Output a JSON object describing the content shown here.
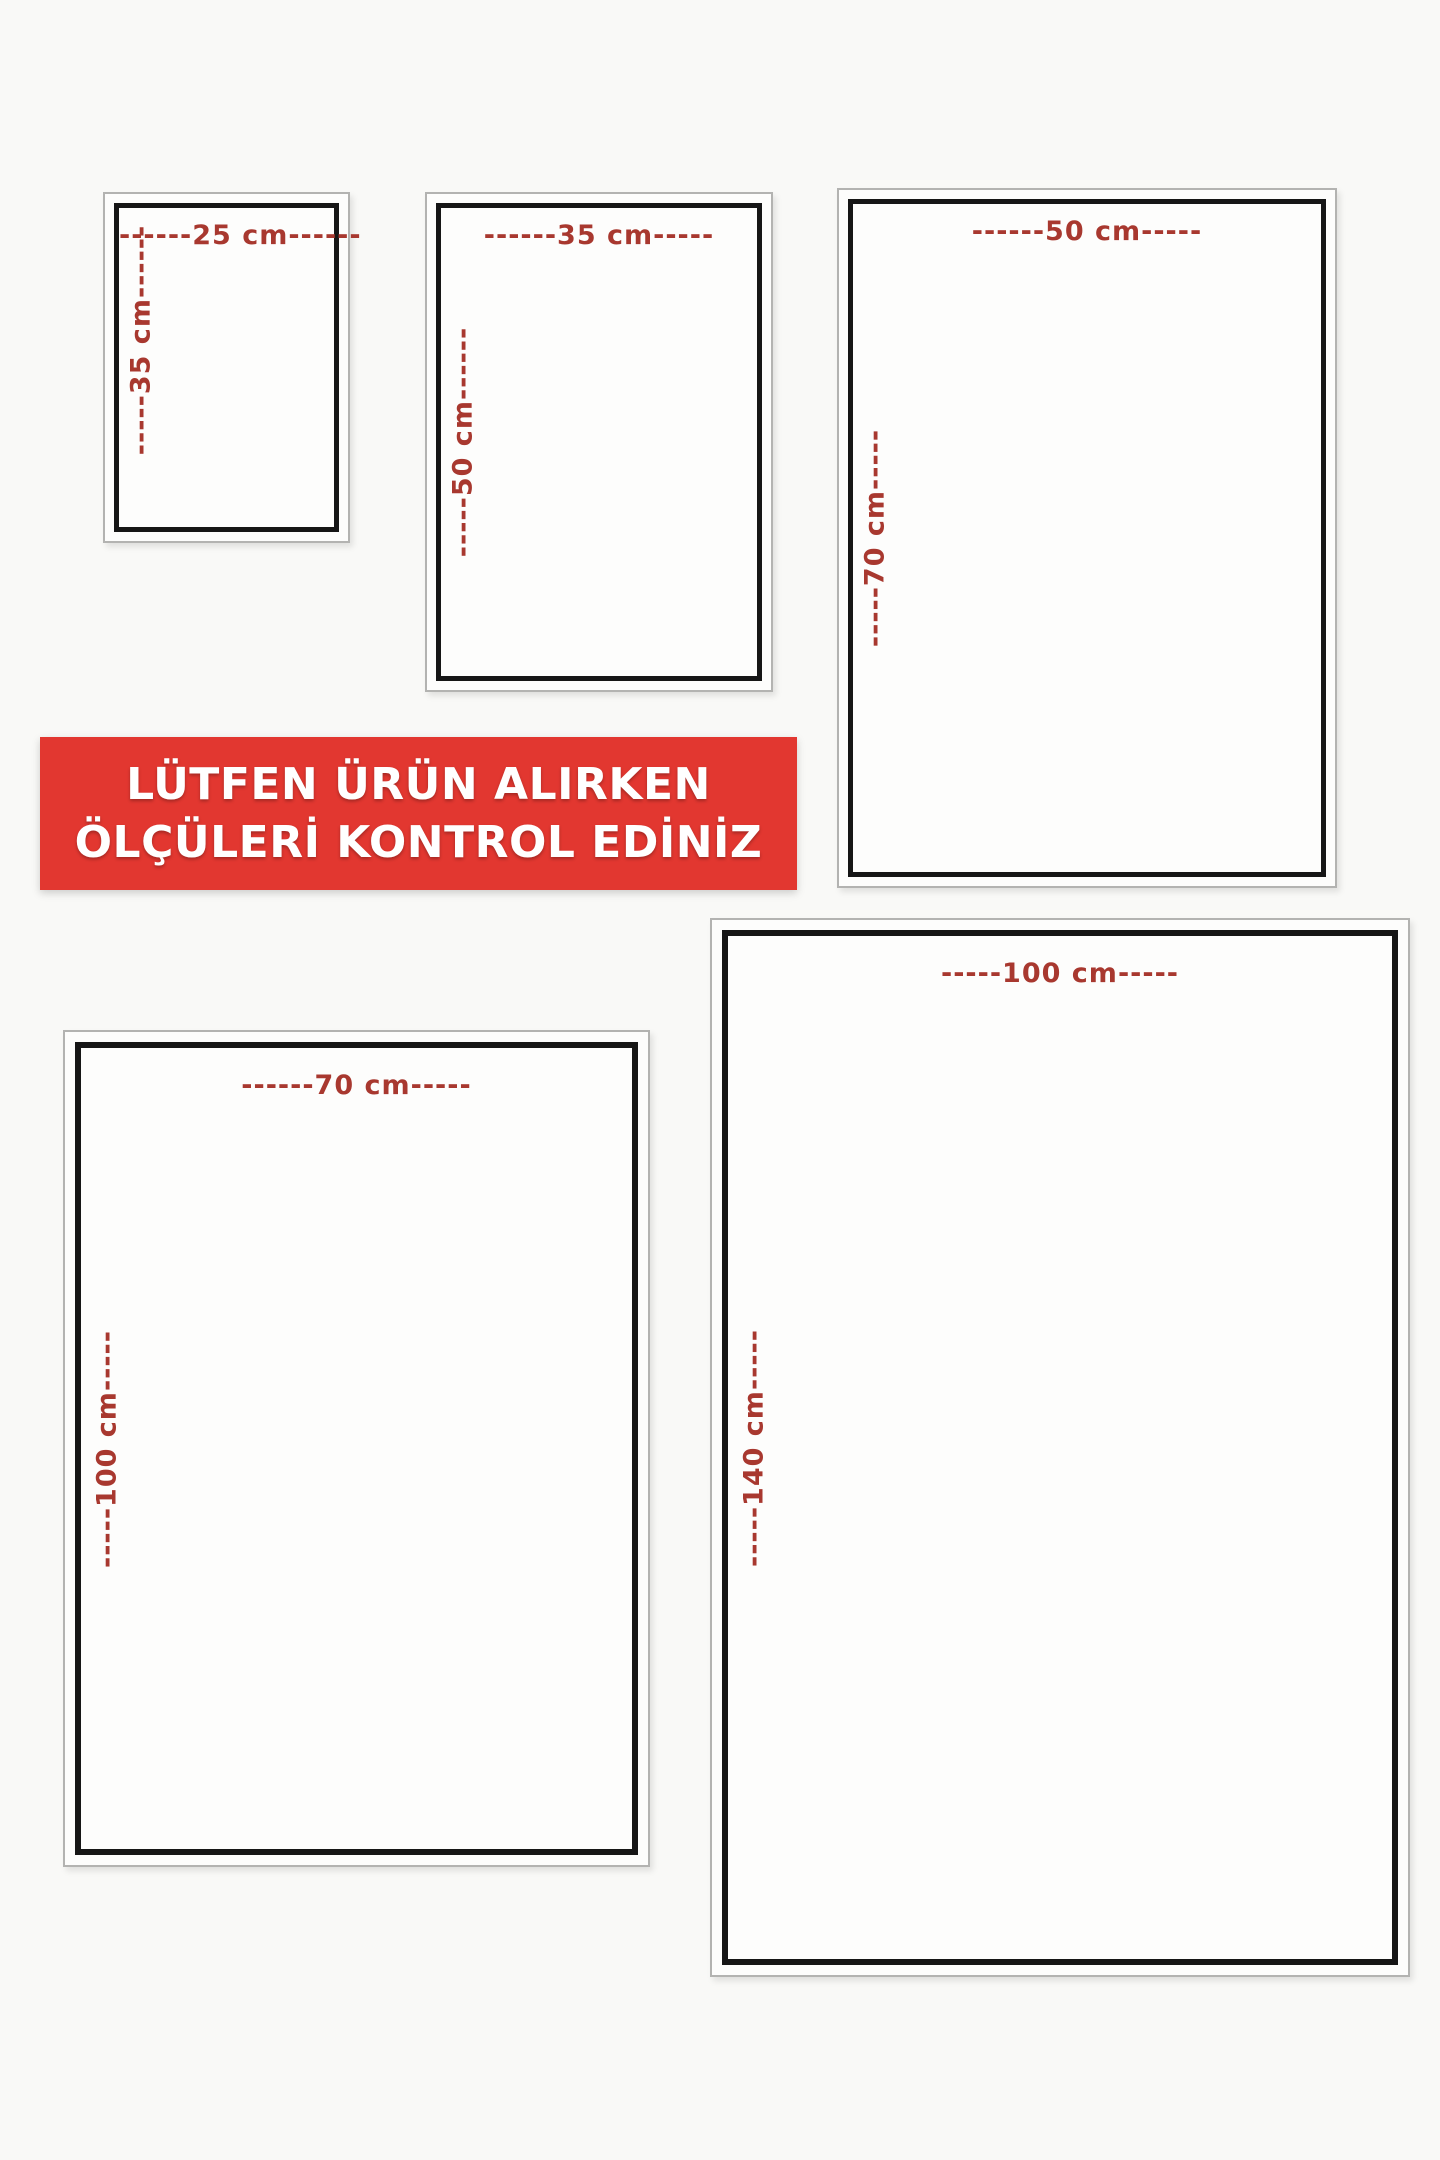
{
  "notice_banner": {
    "line1": "LÜTFEN ÜRÜN ALIRKEN",
    "line2": "ÖLÇÜLERİ KONTROL EDİNİZ",
    "background_color": "#e23730",
    "text_color": "#ffffff"
  },
  "dimension_label_color": "#a8382f",
  "frame_colors": {
    "outer_border": "#b3b3b1",
    "inner_border": "#161616"
  },
  "sizes": [
    {
      "id": "25x35",
      "width_cm": 25,
      "height_cm": 35,
      "top_label": "------25 cm------",
      "side_label": "-----35 cm------"
    },
    {
      "id": "35x50",
      "width_cm": 35,
      "height_cm": 50,
      "top_label": "------35 cm-----",
      "side_label": "-----50 cm------"
    },
    {
      "id": "50x70",
      "width_cm": 50,
      "height_cm": 70,
      "top_label": "------50 cm-----",
      "side_label": "-----70 cm-----"
    },
    {
      "id": "70x100",
      "width_cm": 70,
      "height_cm": 100,
      "top_label": "------70 cm-----",
      "side_label": "-----100 cm-----"
    },
    {
      "id": "100x140",
      "width_cm": 100,
      "height_cm": 140,
      "top_label": "-----100 cm-----",
      "side_label": "-----140 cm-----"
    }
  ]
}
